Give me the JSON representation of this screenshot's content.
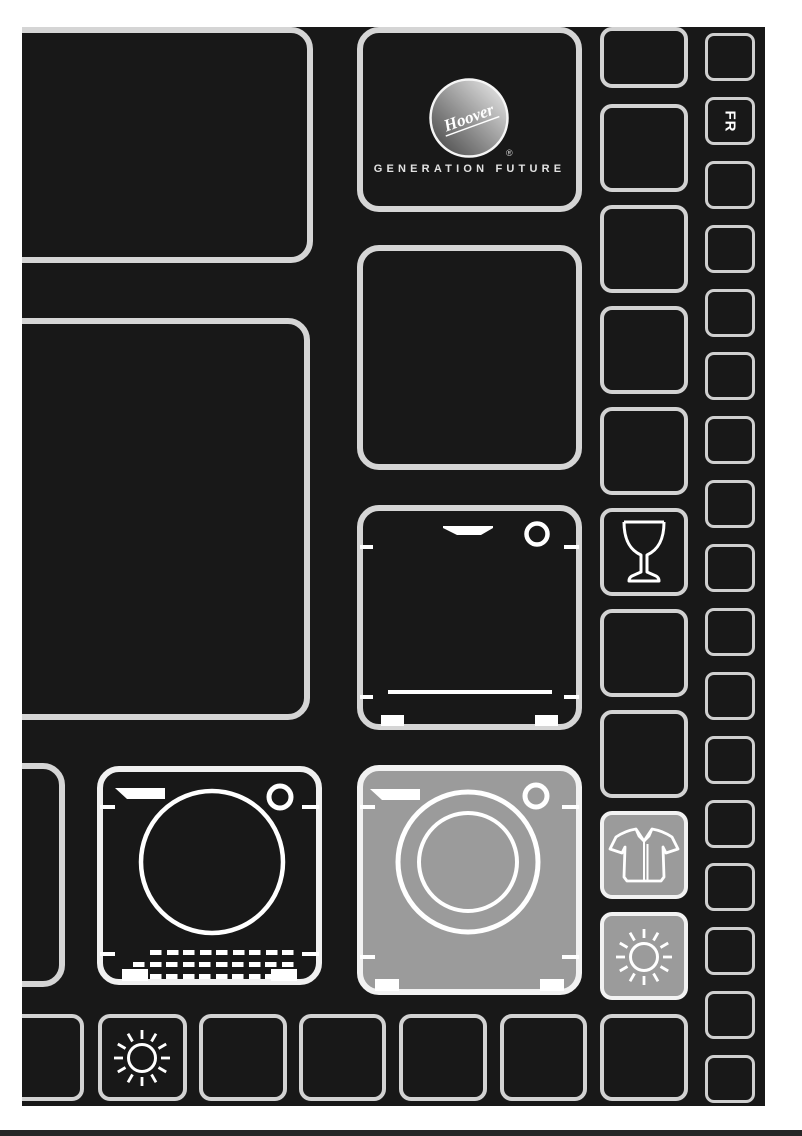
{
  "document": {
    "type": "appliance-manual-cover"
  },
  "brand": {
    "logo_text": "Hoover",
    "registered_mark": "®",
    "tagline": "GENERATION FUTURE"
  },
  "language": {
    "code": "FR"
  },
  "icons": {
    "logo": "hoover-logo-icon",
    "wine_glass": "wine-glass-icon",
    "shirt": "shirt-icon",
    "sun": "sun-icon",
    "washing_machine": "washing-machine-icon",
    "tumble_dryer": "tumble-dryer-icon",
    "dishwasher": "dishwasher-icon"
  },
  "colors": {
    "page_background": "#ffffff",
    "board_background": "#181818",
    "tile_border": "#d5d5d5",
    "icon_tile_border": "#f2f2f2",
    "highlight_fill": "#9b9b9b",
    "icon_stroke": "#ffffff",
    "footer_bar": "#262626"
  }
}
